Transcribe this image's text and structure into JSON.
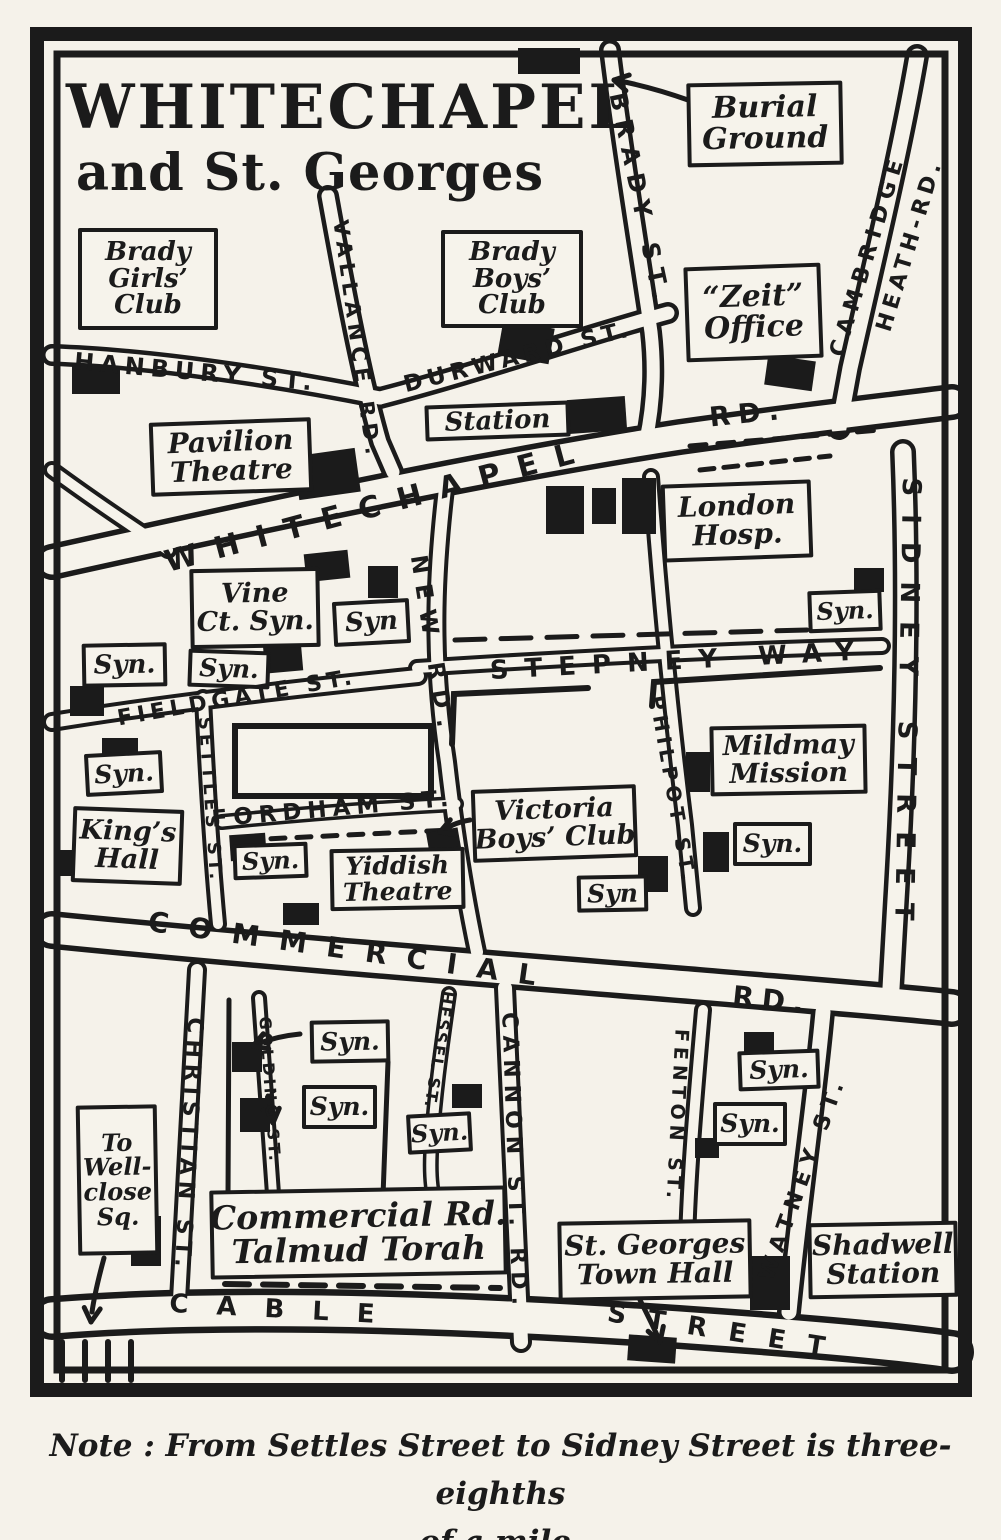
{
  "title": {
    "line1": "WHITECHAPEL",
    "line2": "and St. Georges"
  },
  "note": {
    "line1": "Note : From Settles Street to Sidney Street is three-eighths",
    "line2": "of a mile."
  },
  "colors": {
    "ink": "#1b1b1b",
    "paper": "#f5f2ea",
    "road_fill": "#f6f3eb"
  },
  "map": {
    "frame": {
      "outer": {
        "x": 37,
        "y": 34,
        "w": 928,
        "h": 1356,
        "sw": 14
      },
      "inner": {
        "x": 57,
        "y": 54,
        "w": 888,
        "h": 1316,
        "sw": 7
      }
    },
    "roads": [
      {
        "id": "whitechapel-rd",
        "d": "M 52,562 C 250,518 480,468 680,437 C 800,420 890,410 952,402",
        "outer": 36,
        "inner": 25
      },
      {
        "id": "commercial-rd",
        "d": "M 52,930 C 250,950 480,968 700,986 C 820,996 910,1003 952,1008",
        "outer": 38,
        "inner": 27
      },
      {
        "id": "cable-street",
        "d": "M 52,1318 C 250,1302 520,1315 720,1330 C 830,1338 910,1346 952,1352",
        "outer": 44,
        "inner": 31
      },
      {
        "id": "hanbury-st",
        "d": "M 52,355 C 150,358 280,378 380,398",
        "outer": 22,
        "inner": 13
      },
      {
        "id": "durward-st",
        "d": "M 380,398 C 480,372 580,337 668,313",
        "outer": 22,
        "inner": 13
      },
      {
        "id": "brady-st",
        "d": "M 610,50 C 622,150 641,262 651,332 C 656,376 652,412 646,440",
        "outer": 22,
        "inner": 13
      },
      {
        "id": "cambridge-heath-rd",
        "d": "M 917,56 C 901,150 872,270 850,368 L 839,428",
        "outer": 24,
        "inner": 15
      },
      {
        "id": "vallance-rd",
        "d": "M 328,196 C 345,290 362,380 380,442 L 393,472",
        "outer": 22,
        "inner": 13
      },
      {
        "id": "osborn-stub",
        "d": "M 52,470 C 90,498 130,525 168,550",
        "outer": 18,
        "inner": 10
      },
      {
        "id": "new-rd",
        "d": "M 447,472 C 436,560 430,650 447,762 C 455,832 466,900 477,952",
        "outer": 20,
        "inner": 12
      },
      {
        "id": "sidney-street",
        "d": "M 903,452 C 909,600 905,750 896,900 L 891,988",
        "outer": 26,
        "inner": 17
      },
      {
        "id": "stepney-way",
        "d": "M 417,668 C 570,658 720,650 882,646",
        "outer": 18,
        "inner": 10
      },
      {
        "id": "fieldgate-st",
        "d": "M 52,722 C 150,706 280,690 418,676",
        "outer": 20,
        "inner": 12
      },
      {
        "id": "settles-st",
        "d": "M 203,698 C 207,780 212,860 218,924",
        "outer": 18,
        "inner": 10
      },
      {
        "id": "fordham-st",
        "d": "M 222,822 C 300,814 380,808 456,804",
        "outer": 16,
        "inner": 9
      },
      {
        "id": "philpot-st",
        "d": "M 651,477 C 660,600 672,720 685,825 L 693,908",
        "outer": 18,
        "inner": 10
      },
      {
        "id": "christian-st",
        "d": "M 197,970 C 190,1080 184,1190 179,1300",
        "outer": 20,
        "inner": 12
      },
      {
        "id": "golding-st",
        "d": "M 259,998 C 264,1070 269,1140 273,1194",
        "outer": 16,
        "inner": 8
      },
      {
        "id": "hessel-st",
        "d": "M 449,994 C 441,1050 434,1100 431,1154 C 430,1178 432,1192 435,1202",
        "outer": 16,
        "inner": 9
      },
      {
        "id": "cannon-st-rd",
        "d": "M 505,988 C 511,1100 516,1220 521,1342",
        "outer": 22,
        "inner": 14
      },
      {
        "id": "fenton-st",
        "d": "M 703,1010 C 696,1090 689,1170 687,1242",
        "outer": 18,
        "inner": 10
      },
      {
        "id": "watney-st",
        "d": "M 823,1012 C 815,1100 800,1200 789,1312",
        "outer": 24,
        "inner": 15
      }
    ],
    "extra_lines": [
      {
        "d": "M 229,1000 L 228,1196",
        "w": 5
      },
      {
        "d": "M 388,1062 L 383,1196",
        "w": 5
      },
      {
        "d": "M 452,744 L 454,694 L 588,688",
        "w": 6
      },
      {
        "d": "M 652,706 L 654,682 L 880,668",
        "w": 6
      },
      {
        "d": "M 690,446 L 880,430",
        "w": 5,
        "dash": "16 12"
      },
      {
        "d": "M 700,470 L 830,456",
        "w": 5,
        "dash": "14 10"
      },
      {
        "d": "M 455,640 L 875,628",
        "w": 5,
        "dash": "30 16"
      },
      {
        "d": "M 245,840 L 450,830",
        "w": 5,
        "dash": "14 12"
      },
      {
        "d": "M 225,1284 L 500,1288",
        "w": 6,
        "dash": "24 14"
      },
      {
        "d": "M 62,1342 L 62,1380 M 85,1342 L 85,1380 M 108,1342 L 108,1380 M 131,1342 L 131,1380",
        "w": 6
      }
    ],
    "outline_blocks": [
      {
        "x": 235,
        "y": 726,
        "w": 196,
        "h": 70,
        "sw": 6
      }
    ],
    "buildings": [
      {
        "x": 518,
        "y": 48,
        "w": 62,
        "h": 26,
        "rot": 0
      },
      {
        "x": 766,
        "y": 358,
        "w": 48,
        "h": 30,
        "rot": 8
      },
      {
        "x": 72,
        "y": 366,
        "w": 48,
        "h": 28,
        "rot": 0
      },
      {
        "x": 500,
        "y": 324,
        "w": 52,
        "h": 36,
        "rot": 10
      },
      {
        "x": 568,
        "y": 398,
        "w": 58,
        "h": 34,
        "rot": -4
      },
      {
        "x": 296,
        "y": 452,
        "w": 62,
        "h": 44,
        "rot": -8
      },
      {
        "x": 546,
        "y": 486,
        "w": 38,
        "h": 48,
        "rot": 0
      },
      {
        "x": 592,
        "y": 488,
        "w": 24,
        "h": 36,
        "rot": 0
      },
      {
        "x": 622,
        "y": 478,
        "w": 34,
        "h": 56,
        "rot": 0
      },
      {
        "x": 305,
        "y": 552,
        "w": 44,
        "h": 28,
        "rot": -6
      },
      {
        "x": 368,
        "y": 566,
        "w": 30,
        "h": 32,
        "rot": 0
      },
      {
        "x": 264,
        "y": 642,
        "w": 38,
        "h": 30,
        "rot": -5
      },
      {
        "x": 70,
        "y": 686,
        "w": 34,
        "h": 30,
        "rot": 0
      },
      {
        "x": 102,
        "y": 738,
        "w": 36,
        "h": 22,
        "rot": 0
      },
      {
        "x": 854,
        "y": 568,
        "w": 30,
        "h": 24,
        "rot": 0
      },
      {
        "x": 58,
        "y": 850,
        "w": 24,
        "h": 26,
        "rot": 0
      },
      {
        "x": 230,
        "y": 834,
        "w": 36,
        "h": 26,
        "rot": -4
      },
      {
        "x": 428,
        "y": 830,
        "w": 32,
        "h": 26,
        "rot": -10
      },
      {
        "x": 283,
        "y": 903,
        "w": 36,
        "h": 22,
        "rot": 0
      },
      {
        "x": 638,
        "y": 856,
        "w": 30,
        "h": 36,
        "rot": 0
      },
      {
        "x": 686,
        "y": 752,
        "w": 24,
        "h": 40,
        "rot": 0
      },
      {
        "x": 703,
        "y": 832,
        "w": 26,
        "h": 40,
        "rot": 0
      },
      {
        "x": 232,
        "y": 1042,
        "w": 30,
        "h": 30,
        "rot": 0
      },
      {
        "x": 240,
        "y": 1098,
        "w": 30,
        "h": 34,
        "rot": 0
      },
      {
        "x": 452,
        "y": 1084,
        "w": 30,
        "h": 24,
        "rot": 0
      },
      {
        "x": 744,
        "y": 1032,
        "w": 30,
        "h": 26,
        "rot": 0
      },
      {
        "x": 695,
        "y": 1138,
        "w": 24,
        "h": 20,
        "rot": 0
      },
      {
        "x": 131,
        "y": 1216,
        "w": 30,
        "h": 50,
        "rot": 0
      },
      {
        "x": 750,
        "y": 1256,
        "w": 40,
        "h": 54,
        "rot": 0
      },
      {
        "x": 628,
        "y": 1336,
        "w": 48,
        "h": 26,
        "rot": 4
      }
    ],
    "arrows": [
      {
        "id": "burial-ground-arrow",
        "d": "M 688,100 C 660,90 640,85 620,81",
        "tip": [
          614,
          80
        ],
        "angle": 192
      },
      {
        "id": "victoria-club-arrow",
        "d": "M 470,820 C 458,822 450,826 446,829",
        "tip": [
          440,
          832
        ],
        "angle": 160
      },
      {
        "id": "golding-syn-arrow",
        "d": "M 300,1034 C 280,1036 268,1040 260,1043",
        "tip": [
          253,
          1046
        ],
        "angle": 160
      },
      {
        "id": "golding-label-arrow",
        "d": "M 268,1096 L 272,1116",
        "tip": [
          273,
          1123
        ],
        "angle": 83
      },
      {
        "id": "wellclose-arrow",
        "d": "M 104,1258 C 98,1280 94,1298 92,1312",
        "tip": [
          91,
          1322
        ],
        "angle": 95
      },
      {
        "id": "st-georges-arrow",
        "d": "M 640,1300 C 648,1316 653,1326 657,1335",
        "tip": [
          660,
          1342
        ],
        "angle": 72
      }
    ],
    "boxed_labels": [
      {
        "id": "burial-ground-label",
        "lines": [
          "Burial",
          "Ground"
        ],
        "x": 687,
        "y": 82,
        "w": 156,
        "h": 84,
        "fs": 30,
        "rot": -1
      },
      {
        "id": "zeit-office-label",
        "lines": [
          "“Zeit”",
          "Office"
        ],
        "x": 685,
        "y": 265,
        "w": 137,
        "h": 95,
        "fs": 30,
        "rot": -2
      },
      {
        "id": "brady-girls-club-label",
        "lines": [
          "Brady",
          "Girls’",
          "Club"
        ],
        "x": 78,
        "y": 228,
        "w": 140,
        "h": 102,
        "fs": 26,
        "rot": 0
      },
      {
        "id": "brady-boys-club-label",
        "lines": [
          "Brady",
          "Boys’",
          "Club"
        ],
        "x": 441,
        "y": 230,
        "w": 142,
        "h": 98,
        "fs": 26,
        "rot": 0
      },
      {
        "id": "station-label",
        "lines": [
          "Station"
        ],
        "x": 425,
        "y": 403,
        "w": 145,
        "h": 36,
        "fs": 26,
        "rot": -2
      },
      {
        "id": "pavilion-theatre-label",
        "lines": [
          "Pavilion",
          "Theatre"
        ],
        "x": 150,
        "y": 420,
        "w": 162,
        "h": 74,
        "fs": 28,
        "rot": -2
      },
      {
        "id": "london-hosp-label",
        "lines": [
          "London",
          "Hosp."
        ],
        "x": 662,
        "y": 482,
        "w": 150,
        "h": 78,
        "fs": 28,
        "rot": -2
      },
      {
        "id": "vine-ct-syn-label",
        "lines": [
          "Vine",
          "Ct. Syn."
        ],
        "x": 190,
        "y": 568,
        "w": 130,
        "h": 80,
        "fs": 27,
        "rot": -1
      },
      {
        "id": "syn-new-rd-label",
        "lines": [
          "Syn"
        ],
        "x": 333,
        "y": 600,
        "w": 77,
        "h": 45,
        "fs": 26,
        "rot": -3
      },
      {
        "id": "syn-fieldgate-west-label",
        "lines": [
          "Syn."
        ],
        "x": 82,
        "y": 643,
        "w": 85,
        "h": 44,
        "fs": 26,
        "rot": -1
      },
      {
        "id": "syn-fieldgate-east-label",
        "lines": [
          "Syn."
        ],
        "x": 188,
        "y": 650,
        "w": 82,
        "h": 38,
        "fs": 25,
        "rot": 2
      },
      {
        "id": "syn-sidney-label",
        "lines": [
          "Syn."
        ],
        "x": 808,
        "y": 590,
        "w": 74,
        "h": 42,
        "fs": 24,
        "rot": -2
      },
      {
        "id": "syn-settles-label",
        "lines": [
          "Syn."
        ],
        "x": 85,
        "y": 752,
        "w": 78,
        "h": 43,
        "fs": 25,
        "rot": -3
      },
      {
        "id": "kings-hall-label",
        "lines": [
          "King’s",
          "Hall"
        ],
        "x": 72,
        "y": 808,
        "w": 111,
        "h": 76,
        "fs": 27,
        "rot": 2
      },
      {
        "id": "mildmay-mission-label",
        "lines": [
          "Mildmay",
          "Mission"
        ],
        "x": 710,
        "y": 725,
        "w": 157,
        "h": 70,
        "fs": 27,
        "rot": -1
      },
      {
        "id": "syn-philpot-label",
        "lines": [
          "Syn."
        ],
        "x": 733,
        "y": 822,
        "w": 79,
        "h": 44,
        "fs": 25,
        "rot": 0
      },
      {
        "id": "victoria-boys-club-label",
        "lines": [
          "Victoria",
          "Boys’ Club"
        ],
        "x": 472,
        "y": 787,
        "w": 165,
        "h": 73,
        "fs": 27,
        "rot": -2
      },
      {
        "id": "syn-victoria-label",
        "lines": [
          "Syn"
        ],
        "x": 577,
        "y": 875,
        "w": 71,
        "h": 37,
        "fs": 25,
        "rot": -1
      },
      {
        "id": "syn-fordham-label",
        "lines": [
          "Syn."
        ],
        "x": 233,
        "y": 843,
        "w": 75,
        "h": 36,
        "fs": 24,
        "rot": -2
      },
      {
        "id": "yiddish-theatre-label",
        "lines": [
          "Yiddish",
          "Theatre"
        ],
        "x": 330,
        "y": 848,
        "w": 135,
        "h": 62,
        "fs": 25,
        "rot": -1
      },
      {
        "id": "syn-golding-1-label",
        "lines": [
          "Syn."
        ],
        "x": 310,
        "y": 1020,
        "w": 80,
        "h": 43,
        "fs": 25,
        "rot": -1
      },
      {
        "id": "syn-golding-2-label",
        "lines": [
          "Syn."
        ],
        "x": 302,
        "y": 1085,
        "w": 75,
        "h": 44,
        "fs": 25,
        "rot": 0
      },
      {
        "id": "syn-hessel-label",
        "lines": [
          "Syn."
        ],
        "x": 407,
        "y": 1113,
        "w": 65,
        "h": 40,
        "fs": 24,
        "rot": -3
      },
      {
        "id": "syn-fenton-1-label",
        "lines": [
          "Syn."
        ],
        "x": 738,
        "y": 1050,
        "w": 82,
        "h": 40,
        "fs": 25,
        "rot": -2
      },
      {
        "id": "syn-fenton-2-label",
        "lines": [
          "Syn."
        ],
        "x": 713,
        "y": 1102,
        "w": 74,
        "h": 44,
        "fs": 25,
        "rot": 0
      },
      {
        "id": "to-wellclose-sq-label",
        "lines": [
          "To",
          "Well-",
          "close",
          "Sq."
        ],
        "x": 77,
        "y": 1105,
        "w": 81,
        "h": 150,
        "fs": 24,
        "rot": -1
      },
      {
        "id": "talmud-torah-label",
        "lines": [
          "Commercial Rd.",
          "Talmud Torah"
        ],
        "x": 210,
        "y": 1188,
        "w": 297,
        "h": 89,
        "fs": 33,
        "rot": -1
      },
      {
        "id": "st-georges-town-hall-label",
        "lines": [
          "St. Georges",
          "Town Hall"
        ],
        "x": 558,
        "y": 1220,
        "w": 194,
        "h": 80,
        "fs": 28,
        "rot": -1
      },
      {
        "id": "shadwell-station-label",
        "lines": [
          "Shadwell",
          "Station"
        ],
        "x": 808,
        "y": 1222,
        "w": 150,
        "h": 76,
        "fs": 28,
        "rot": -1
      }
    ],
    "street_labels": [
      {
        "id": "hanbury-st-name",
        "text": "HANBURY ST.",
        "x": 196,
        "y": 372,
        "rot": 5,
        "fs": 24,
        "ls": 6
      },
      {
        "id": "durward-st-name",
        "text": "DURWARD ST.",
        "x": 518,
        "y": 357,
        "rot": -14,
        "fs": 23,
        "ls": 5
      },
      {
        "id": "brady-st-name",
        "text": "BRADY ST.",
        "x": 640,
        "y": 200,
        "rot": 78,
        "fs": 24,
        "ls": 9
      },
      {
        "id": "cambridge-name",
        "text": "CAMBRIDGE",
        "x": 868,
        "y": 255,
        "rot": -73,
        "fs": 22,
        "ls": 7
      },
      {
        "id": "heath-rd-name",
        "text": "HEATH-RD.",
        "x": 910,
        "y": 245,
        "rot": -73,
        "fs": 22,
        "ls": 5
      },
      {
        "id": "vallance-rd-name",
        "text": "VALLANCE RD.",
        "x": 357,
        "y": 340,
        "rot": 82,
        "fs": 21,
        "ls": 6
      },
      {
        "id": "whitechapel-name",
        "text": "WHITECHAPEL",
        "x": 378,
        "y": 506,
        "rot": -15,
        "fs": 30,
        "ls": 18
      },
      {
        "id": "whitechapel-rd-suffix",
        "text": "RD.",
        "x": 748,
        "y": 414,
        "rot": -6,
        "fs": 27,
        "ls": 8
      },
      {
        "id": "new-rd-name",
        "text": "NEW RD.",
        "x": 432,
        "y": 646,
        "rot": 81,
        "fs": 23,
        "ls": 10
      },
      {
        "id": "sidney-street-name",
        "text": "SIDNEY STREET",
        "x": 907,
        "y": 708,
        "rot": 91,
        "fs": 26,
        "ls": 18
      },
      {
        "id": "stepney-way-name",
        "text": "STEPNEY WAY",
        "x": 680,
        "y": 661,
        "rot": -3,
        "fs": 26,
        "ls": 16
      },
      {
        "id": "fieldgate-st-name",
        "text": "FIELDGATE ST.",
        "x": 237,
        "y": 698,
        "rot": -10,
        "fs": 22,
        "ls": 5
      },
      {
        "id": "settles-st-name",
        "text": "SETTLES ST.",
        "x": 210,
        "y": 800,
        "rot": 86,
        "fs": 18,
        "ls": 4
      },
      {
        "id": "fordham-st-name",
        "text": "FORDHAM ST.",
        "x": 333,
        "y": 809,
        "rot": -5,
        "fs": 23,
        "ls": 6
      },
      {
        "id": "philpot-st-name",
        "text": "PHILPOT ST.",
        "x": 673,
        "y": 790,
        "rot": 80,
        "fs": 20,
        "ls": 5
      },
      {
        "id": "commercial-name",
        "text": "COMMERCIAL",
        "x": 352,
        "y": 950,
        "rot": 8,
        "fs": 28,
        "ls": 20
      },
      {
        "id": "commercial-rd-suffix",
        "text": "RD.",
        "x": 772,
        "y": 1000,
        "rot": 6,
        "fs": 28,
        "ls": 8
      },
      {
        "id": "christian-st-name",
        "text": "CHRISTIAN ST.",
        "x": 188,
        "y": 1145,
        "rot": 93,
        "fs": 22,
        "ls": 6
      },
      {
        "id": "golding-st-name",
        "text": "GOLDING ST.",
        "x": 270,
        "y": 1090,
        "rot": 86,
        "fs": 16,
        "ls": 3
      },
      {
        "id": "hessel-st-name",
        "text": "HESSEL ST.",
        "x": 439,
        "y": 1050,
        "rot": 99,
        "fs": 16,
        "ls": 2
      },
      {
        "id": "cannon-st-rd-name",
        "text": "CANNON ST. RD.",
        "x": 514,
        "y": 1162,
        "rot": 88,
        "fs": 22,
        "ls": 7
      },
      {
        "id": "fenton-st-name",
        "text": "FENTON ST.",
        "x": 677,
        "y": 1116,
        "rot": 93,
        "fs": 19,
        "ls": 5
      },
      {
        "id": "watney-st-name",
        "text": "WATNEY ST.",
        "x": 803,
        "y": 1178,
        "rot": -70,
        "fs": 22,
        "ls": 7
      },
      {
        "id": "cable-name",
        "text": "CABLE",
        "x": 286,
        "y": 1310,
        "rot": 3,
        "fs": 26,
        "ls": 28
      },
      {
        "id": "cable-street-suffix",
        "text": "STREET",
        "x": 727,
        "y": 1332,
        "rot": 9,
        "fs": 26,
        "ls": 22
      }
    ]
  }
}
